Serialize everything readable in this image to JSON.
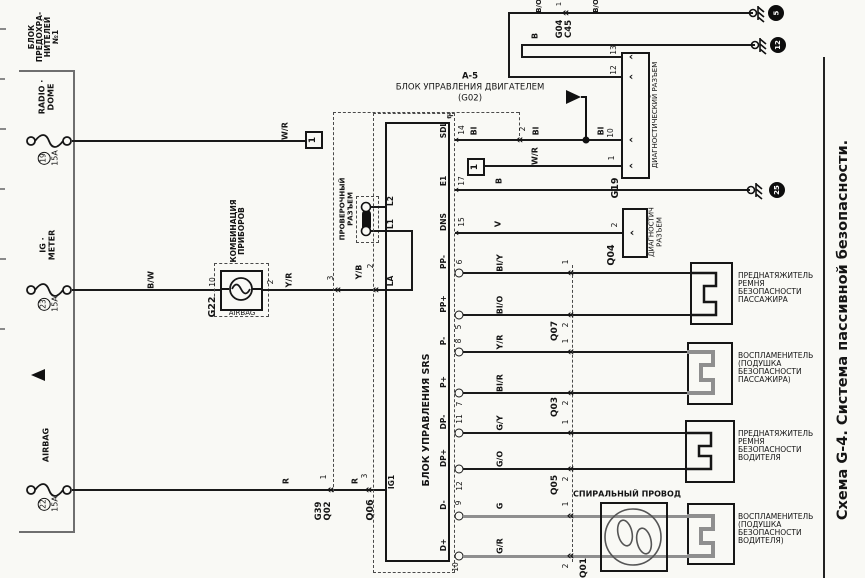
{
  "page": {
    "title": "Схема G-4. Система пассивной безопасности."
  },
  "colors": {
    "ink": "#1a1a1a",
    "wire_gray": "#8f8f8f",
    "paper": "#f9f9f5"
  },
  "fuse_block": {
    "label_lines": [
      "БЛОК",
      "ПРЕДОХРА-",
      "НИТЕЛЕЙ",
      "№1"
    ],
    "fuses": [
      {
        "circuit1": "RADIO ·",
        "circuit2": "DOME",
        "num": "19",
        "amp": "15A"
      },
      {
        "circuit1": "IG ·",
        "circuit2": "METER",
        "num": "23",
        "amp": "15A"
      },
      {
        "circuit1": "AIRBAG",
        "circuit2": "",
        "num": "22",
        "amp": "15A"
      }
    ]
  },
  "cluster": {
    "code": "G22",
    "label1": "КОМБИНАЦИЯ",
    "label2": "ПРИБОРОВ",
    "lamp": "AIRBAG",
    "pin_in": "10",
    "pin_out": "2"
  },
  "check_connector": {
    "label1": "ПРОВЕРОЧНЫЙ",
    "label2": "РАЗЪЕМ"
  },
  "srs": {
    "label": "БЛОК УПРАВЛЕНИЯ SRS",
    "code": "Q06",
    "top_terminals": {
      "ig1": "IG1",
      "la": "LA",
      "l1": "L1",
      "l2": "L2",
      "pin_ig1": "3",
      "pin_la": "2"
    },
    "pins": [
      {
        "t": "SDL",
        "n": "14"
      },
      {
        "t": "E1",
        "n": "17"
      },
      {
        "t": "DNS",
        "n": "15"
      },
      {
        "t": "PP-",
        "n": "6"
      },
      {
        "t": "PP+",
        "n": "5"
      },
      {
        "t": "P-",
        "n": "8"
      },
      {
        "t": "P+",
        "n": "7"
      },
      {
        "t": "DP-",
        "n": "11"
      },
      {
        "t": "DP+",
        "n": "12"
      },
      {
        "t": "D-",
        "n": "9"
      },
      {
        "t": "D+",
        "n": "10"
      }
    ]
  },
  "engine_ecu": {
    "line1": "А-5",
    "line2": "БЛОК УПРАВЛЕНИЯ ДВИГАТЕЛЕМ",
    "line3": "(G02)"
  },
  "diag_connector": {
    "code": "G19",
    "label": "ДИАГНОСТИЧЕСКИЙ РАЗЪЕМ",
    "pins": [
      "13",
      "12",
      "10",
      "1"
    ]
  },
  "diag_connector2": {
    "code": "Q04",
    "label1": "ДИАГНОСТИЧ",
    "label2": "РАЗЪЕМ",
    "pin": "2"
  },
  "connectors": {
    "g39_1": "G39",
    "g39_2": "Q02",
    "g39_pin_lamp": "3",
    "g39_pin_ig": "1",
    "g04_1": "G04",
    "g04_2": "C45",
    "g04_pin": "1",
    "q06_pin_la": "2",
    "q06_pin_ig1": "3",
    "q07": "Q07",
    "q03": "Q03",
    "q05": "Q05",
    "q01": "Q01",
    "link1": "1",
    "sdl_ecu_pin": "2",
    "q_pins": [
      "1",
      "2",
      "1",
      "2",
      "1",
      "2",
      "1",
      "2"
    ]
  },
  "wire_labels": {
    "wr1": "W/R",
    "bw": "B/W",
    "yr_lamp": "Y/R",
    "yb": "Y/B",
    "r1": "R",
    "r2": "R",
    "bl1": "Bl",
    "bl2": "Bl",
    "bl3": "Bl",
    "wr2": "W/R",
    "b_g19": "B",
    "bo1": "B/O",
    "bo2": "B/O",
    "b_e1": "B",
    "v": "V",
    "bly": "Bl/Y",
    "blo": "Bl/O",
    "yr": "Y/R",
    "blr": "Bl/R",
    "gy": "G/Y",
    "go": "G/O",
    "g": "G",
    "gr": "G/R"
  },
  "grounds": [
    "5",
    "12",
    "25"
  ],
  "spiral": {
    "label": "СПИРАЛЬНЫЙ ПРОВОД"
  },
  "loads": [
    {
      "lines": [
        "ПРЕДНАТЯЖИТЕЛЬ",
        "РЕМНЯ",
        "БЕЗОПАСНОСТИ",
        "ПАССАЖИРА"
      ]
    },
    {
      "lines": [
        "ВОСПЛАМЕНИТЕЛЬ",
        "(ПОДУШКА",
        "БЕЗОПАСНОСТИ",
        "ПАССАЖИРА)"
      ]
    },
    {
      "lines": [
        "ПРЕДНАТЯЖИТЕЛЬ",
        "РЕМНЯ",
        "БЕЗОПАСНОСТИ",
        "ВОДИТЕЛЯ"
      ]
    },
    {
      "lines": [
        "ВОСПЛАМЕНИТЕЛЬ",
        "(ПОДУШКА",
        "БЕЗОПАСНОСТИ",
        "ВОДИТЕЛЯ)"
      ]
    }
  ]
}
